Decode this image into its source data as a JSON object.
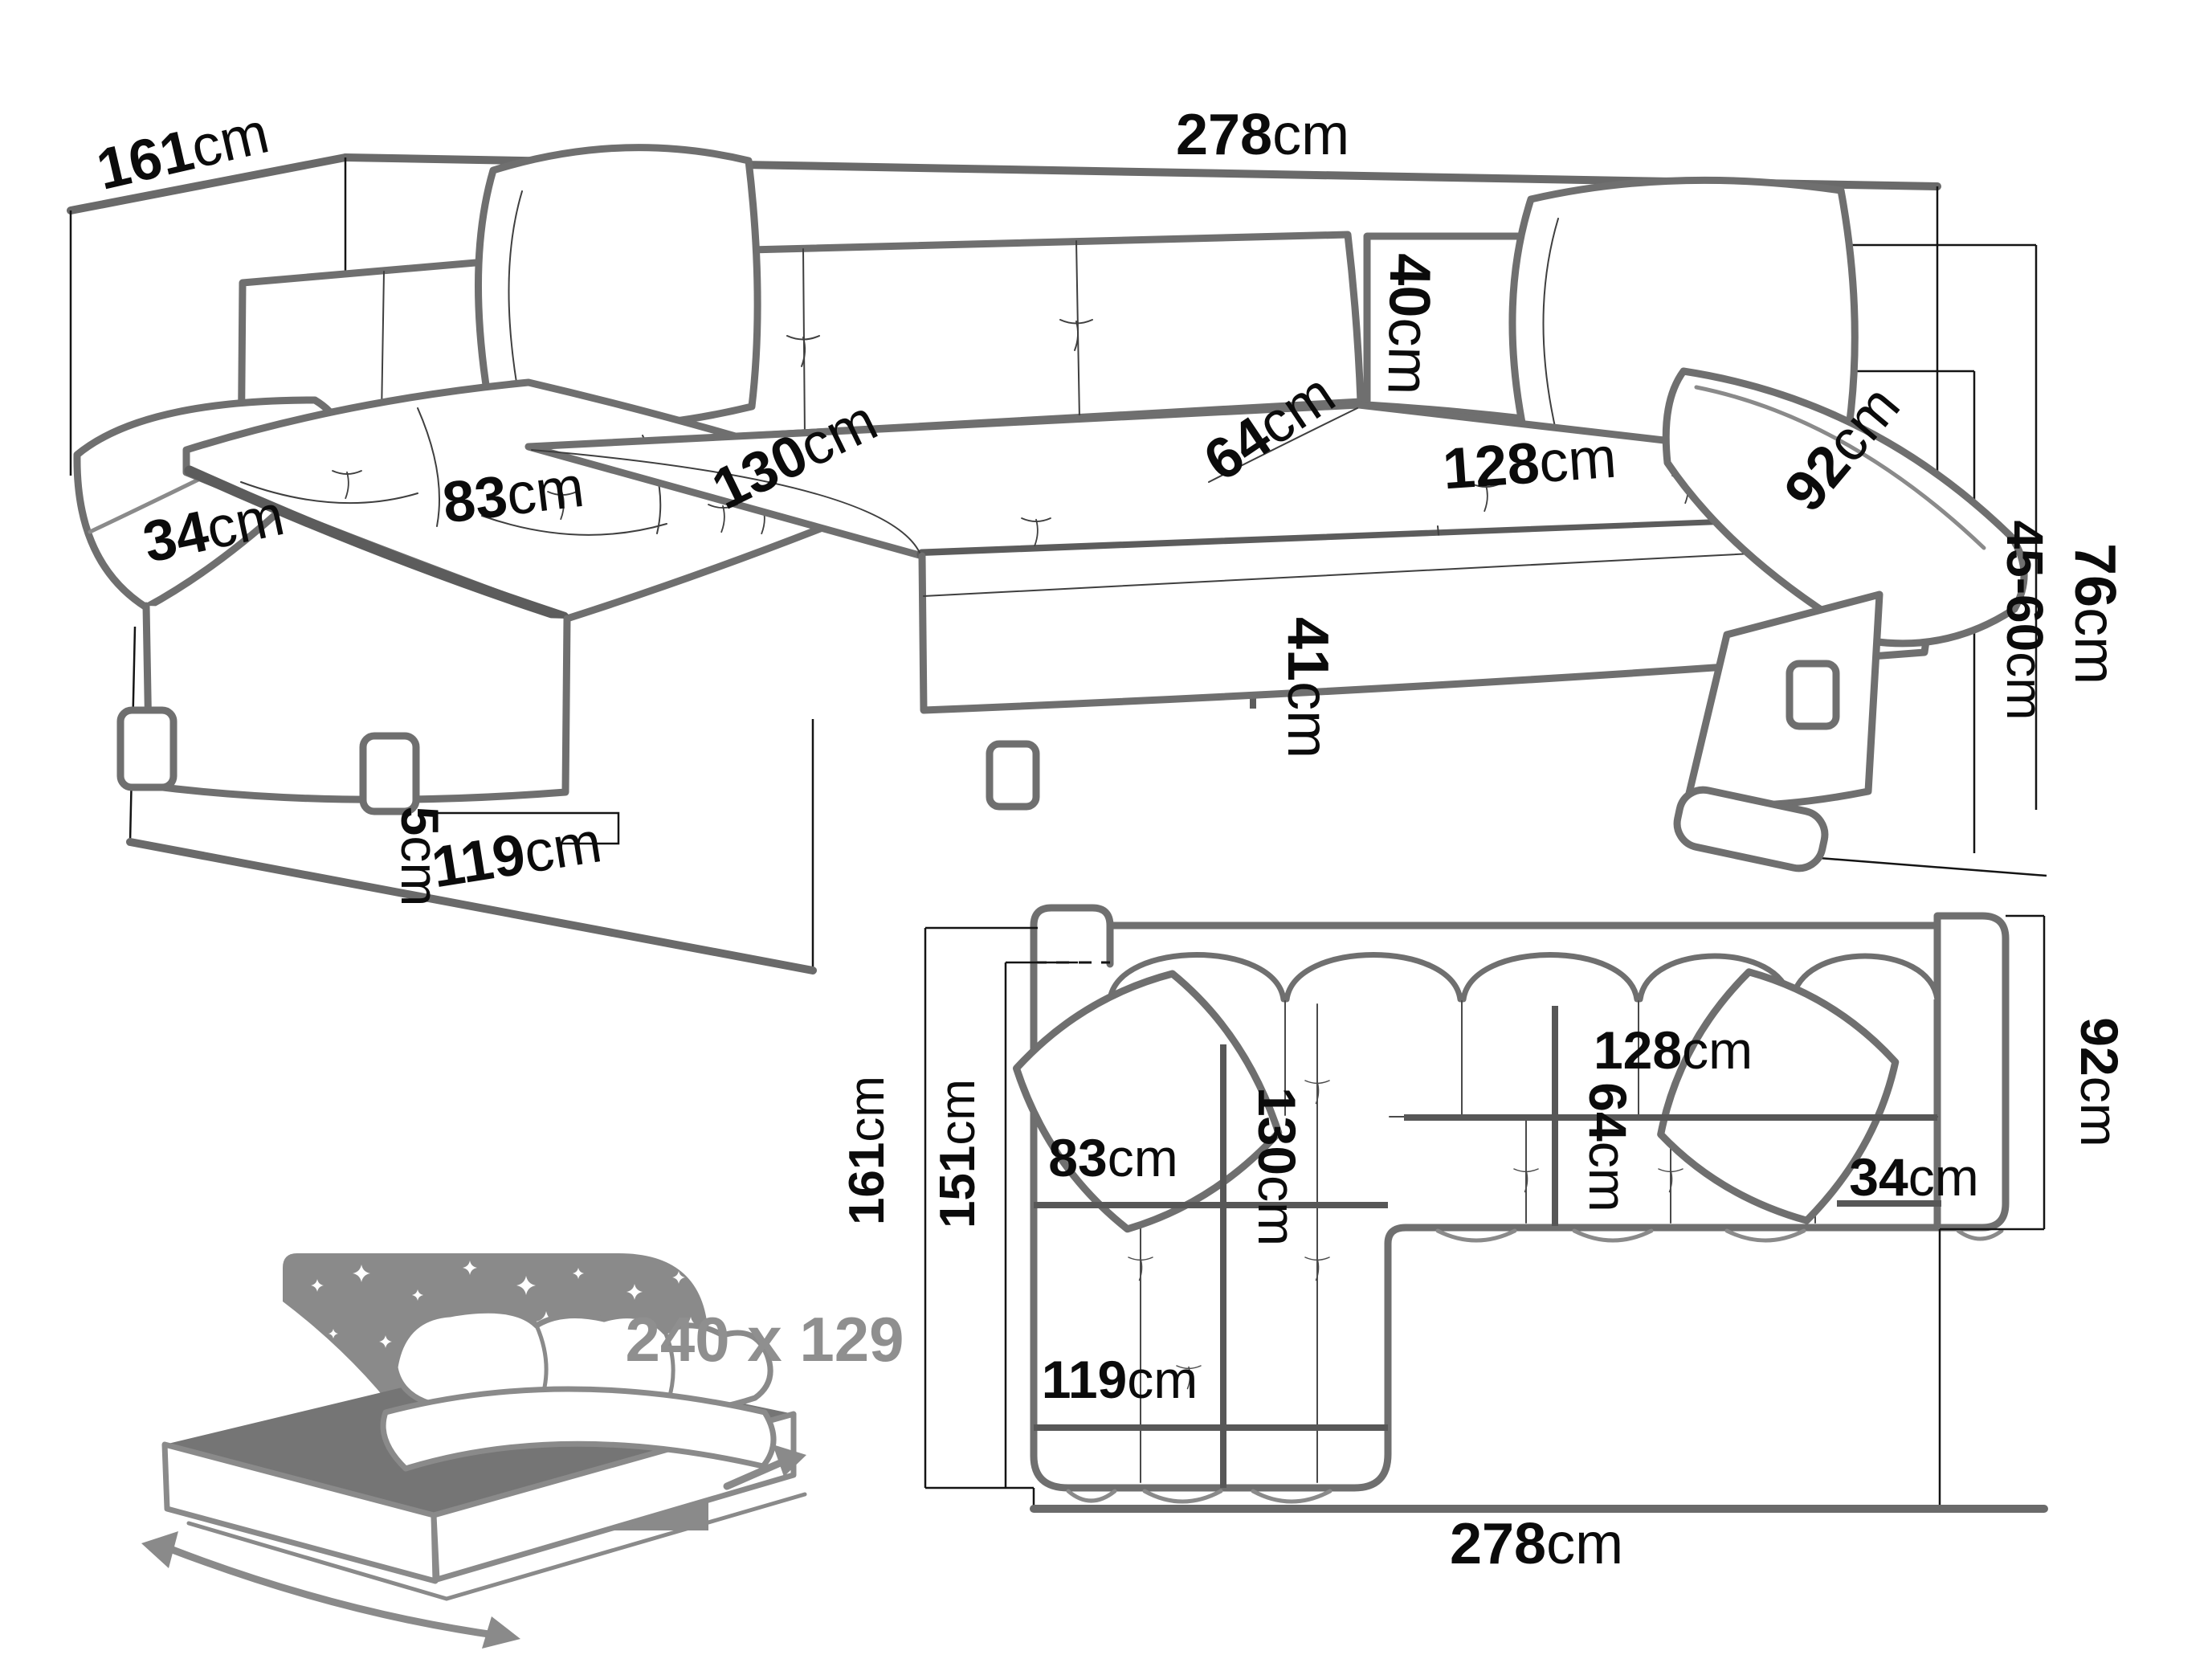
{
  "perspective": {
    "dims": {
      "width_total": {
        "v": "278",
        "u": "cm"
      },
      "depth_total": {
        "v": "161",
        "u": "cm"
      },
      "backrest_height": {
        "v": "40",
        "u": "cm"
      },
      "seat_depth": {
        "v": "64",
        "u": "cm"
      },
      "seat_width": {
        "v": "128",
        "u": "cm"
      },
      "chaise_length": {
        "v": "130",
        "u": "cm"
      },
      "chaise_width": {
        "v": "83",
        "u": "cm"
      },
      "arm_width": {
        "v": "34",
        "u": "cm"
      },
      "arm_length": {
        "v": "92",
        "u": "cm"
      },
      "height_total": {
        "v": "76",
        "u": "cm"
      },
      "seat_height": {
        "v": "45-60",
        "u": "cm"
      },
      "base_height": {
        "v": "41",
        "u": "cm"
      },
      "leg_height": {
        "v": "5",
        "u": "cm"
      },
      "chaise_front_width": {
        "v": "119",
        "u": "cm"
      }
    }
  },
  "plan": {
    "dims": {
      "depth_total": {
        "v": "161",
        "u": "cm"
      },
      "depth_inner": {
        "v": "151",
        "u": "cm"
      },
      "chaise_length": {
        "v": "130",
        "u": "cm"
      },
      "seat_depth": {
        "v": "64",
        "u": "cm"
      },
      "chaise_width": {
        "v": "83",
        "u": "cm"
      },
      "seat_width": {
        "v": "128",
        "u": "cm"
      },
      "arm_width": {
        "v": "34",
        "u": "cm"
      },
      "arm_length": {
        "v": "92",
        "u": "cm"
      },
      "chaise_front_width": {
        "v": "119",
        "u": "cm"
      },
      "width_total": {
        "v": "278",
        "u": "cm"
      }
    }
  },
  "bed": {
    "sleeping_area": "240 x 129"
  }
}
